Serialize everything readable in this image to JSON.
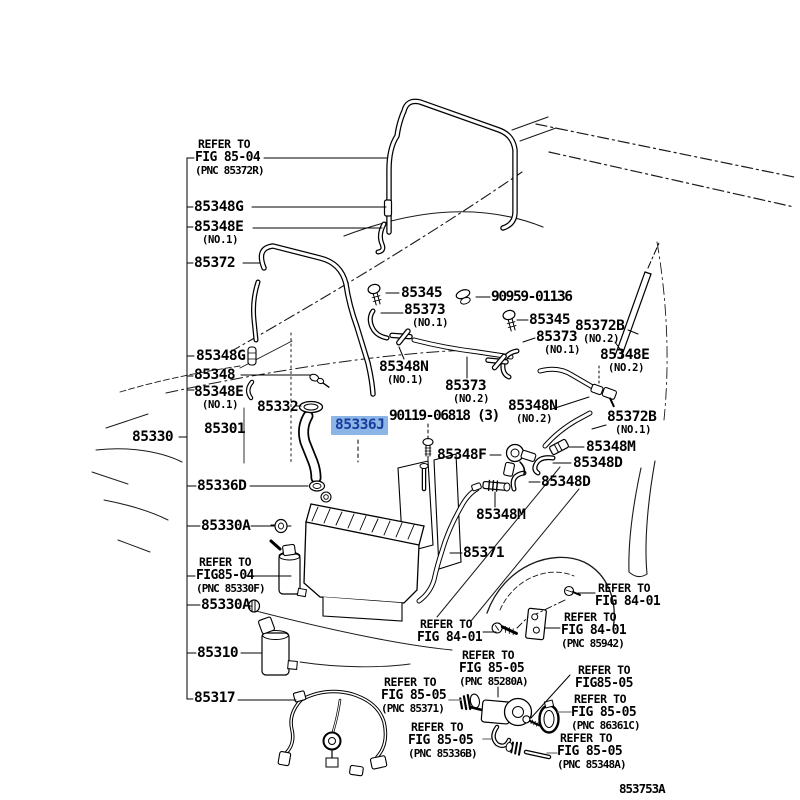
{
  "figure": {
    "code": "853753A"
  },
  "colors": {
    "highlight_bg": "#8ab5e6",
    "highlight_fg": "#1b3a9c",
    "ink": "#000000",
    "gray_leader": "#8f8f8f"
  },
  "selected_part": {
    "text": "85336J"
  },
  "parts": [
    {
      "text": "85348G",
      "qualifier": ""
    },
    {
      "text": "85348E",
      "qualifier": "(NO.1)"
    },
    {
      "text": "85372",
      "qualifier": ""
    },
    {
      "text": "85348G",
      "qualifier": ""
    },
    {
      "text": "85348",
      "qualifier": ""
    },
    {
      "text": "85348E",
      "qualifier": "(NO.1)"
    },
    {
      "text": "85332",
      "qualifier": ""
    },
    {
      "text": "85301",
      "qualifier": ""
    },
    {
      "text": "85330",
      "qualifier": ""
    },
    {
      "text": "85336D",
      "qualifier": ""
    },
    {
      "text": "85330A",
      "qualifier": ""
    },
    {
      "text": "85330A",
      "qualifier": ""
    },
    {
      "text": "85310",
      "qualifier": ""
    },
    {
      "text": "85317",
      "qualifier": ""
    },
    {
      "text": "85345",
      "qualifier": ""
    },
    {
      "text": "85373",
      "qualifier": "(NO.1)"
    },
    {
      "text": "90959-01136",
      "qualifier": ""
    },
    {
      "text": "85345",
      "qualifier": ""
    },
    {
      "text": "85373",
      "qualifier": "(NO.1)"
    },
    {
      "text": "85372B",
      "qualifier": "(NO.2)"
    },
    {
      "text": "85348E",
      "qualifier": "(NO.2)"
    },
    {
      "text": "85348N",
      "qualifier": "(NO.1)"
    },
    {
      "text": "85373",
      "qualifier": "(NO.2)"
    },
    {
      "text": "85348N",
      "qualifier": "(NO.2)"
    },
    {
      "text": "90119-06818 (3)",
      "qualifier": ""
    },
    {
      "text": "85348F",
      "qualifier": ""
    },
    {
      "text": "85372B",
      "qualifier": "(NO.1)"
    },
    {
      "text": "85348M",
      "qualifier": ""
    },
    {
      "text": "85348D",
      "qualifier": ""
    },
    {
      "text": "85348D",
      "qualifier": ""
    },
    {
      "text": "85348M",
      "qualifier": ""
    },
    {
      "text": "85371",
      "qualifier": ""
    }
  ],
  "refs": [
    {
      "l1": "REFER TO",
      "l2": "FIG 85-04",
      "l3": "(PNC 85372R)"
    },
    {
      "l1": "REFER TO",
      "l2": "FIG85-04",
      "l3": "(PNC 85330F)"
    },
    {
      "l1": "REFER TO",
      "l2": "FIG 84-01",
      "l3": ""
    },
    {
      "l1": "REFER TO",
      "l2": "FIG 84-01",
      "l3": ""
    },
    {
      "l1": "REFER TO",
      "l2": "FIG 84-01",
      "l3": "(PNC 85942)"
    },
    {
      "l1": "REFER TO",
      "l2": "FIG 85-05",
      "l3": "(PNC 85280A)"
    },
    {
      "l1": "REFER TO",
      "l2": "FIG 85-05",
      "l3": "(PNC 85371)"
    },
    {
      "l1": "REFER TO",
      "l2": "FIG85-05",
      "l3": ""
    },
    {
      "l1": "REFER TO",
      "l2": "FIG 85-05",
      "l3": "(PNC 86361C)"
    },
    {
      "l1": "REFER TO",
      "l2": "FIG 85-05",
      "l3": "(PNC 85336B)"
    },
    {
      "l1": "REFER TO",
      "l2": "FIG 85-05",
      "l3": "(PNC 85348A)"
    }
  ]
}
